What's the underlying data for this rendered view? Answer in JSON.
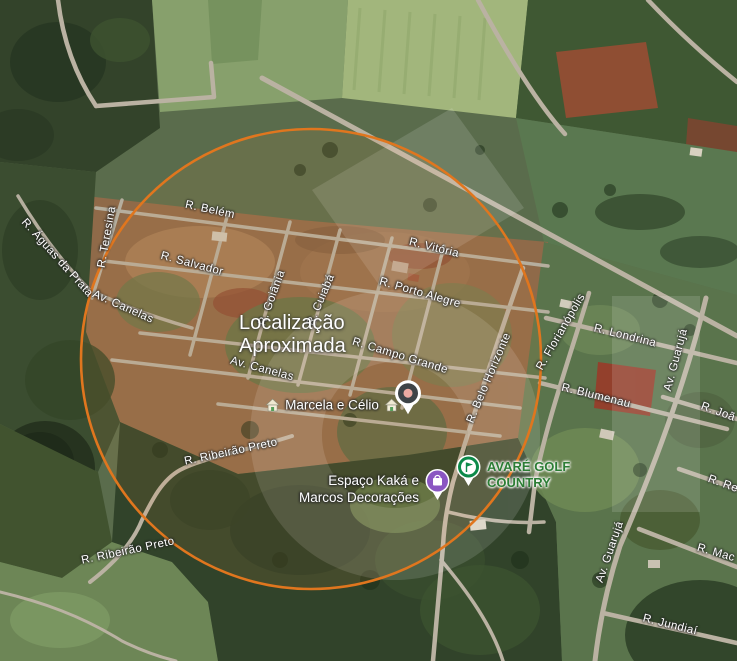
{
  "map": {
    "view": "satellite",
    "approximate_location": {
      "line1": "Localização",
      "line2": "Aproximada"
    },
    "approximate_circle_color": "#e0761e"
  },
  "streets": [
    {
      "label": "R. Belém"
    },
    {
      "label": "R. Vitória"
    },
    {
      "label": "R. Salvador"
    },
    {
      "label": "R. Porto Alegre"
    },
    {
      "label": "Av. Canelas"
    },
    {
      "label": "R. Teresina"
    },
    {
      "label": "R. Águas da Prata"
    },
    {
      "label": "R. Goiânia"
    },
    {
      "label": "R. Cuiabá"
    },
    {
      "label": "R. Campo Grande"
    },
    {
      "label": "Av. Canelas"
    },
    {
      "label": "R. Belo Horizonte"
    },
    {
      "label": "R. Ribeirão Preto"
    },
    {
      "label": "R. Ribeirão Preto"
    },
    {
      "label": "R. Florianópolis"
    },
    {
      "label": "R. Londrina"
    },
    {
      "label": "R. Blumenau"
    },
    {
      "label": "Av. Guarujá"
    },
    {
      "label": "R. Joã"
    },
    {
      "label": "R. Re"
    },
    {
      "label": "Av. Guarujá"
    },
    {
      "label": "R. Mac"
    },
    {
      "label": "R. Jundiaí"
    }
  ],
  "pois": {
    "marcela": {
      "name": "Marcela e Célio",
      "icon": "lodging-house-icon"
    },
    "espaco": {
      "line1": "Espaço Kaká e",
      "line2": "Marcos Decorações",
      "pin_color": "#8a56c2"
    },
    "avare": {
      "line1": "AVARÉ GOLF",
      "line2": "COUNTRY",
      "text_color": "#2c7d35",
      "pin_color": "#0c8a4a"
    }
  }
}
